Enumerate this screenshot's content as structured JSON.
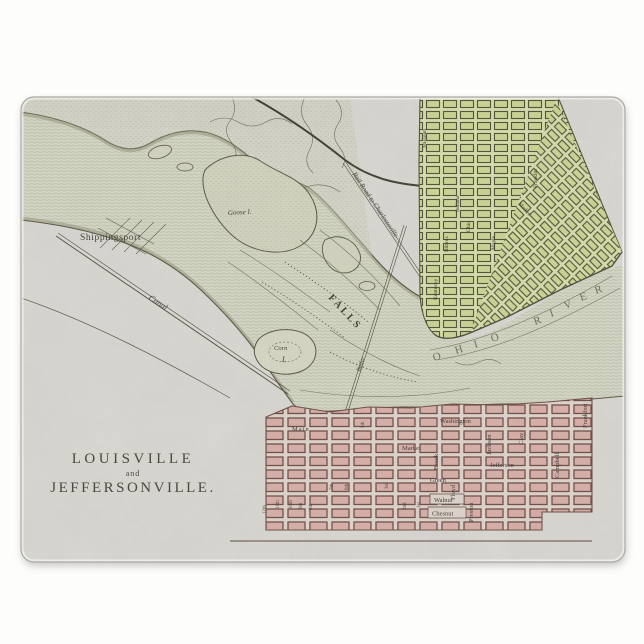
{
  "board": {
    "background_color": "#fdfdfc",
    "surface_color": "#d9d7d1",
    "edge_highlight": "#f1f0ed",
    "shadow_color": "#b9b7b1"
  },
  "map": {
    "title": {
      "line1": "LOUISVILLE",
      "line2": "and",
      "line3": "JEFFERSONVILLE."
    },
    "place_labels": {
      "shippingsport": "Shippingsport",
      "canal": "Canal",
      "goose_island": "Goose I.",
      "corn_island_line1": "Corn",
      "corn_island_line2": "I.",
      "falls": "FALLS",
      "butler": "Butler",
      "railroad": "Rail Road to Charlestoville",
      "shore_fragment": "nd"
    },
    "river": {
      "letters": [
        "O",
        "H",
        "I",
        "O",
        "R",
        "I",
        "V",
        "E",
        "R"
      ]
    },
    "louisville": {
      "grid_color": "#d6ada6",
      "streets_horizontal": [
        "Main",
        "Market",
        "Jefferson",
        "Green",
        "Walnut",
        "Chesnut",
        "Washington"
      ],
      "streets_vertical": [
        "Brook",
        "Floyd",
        "Preston",
        "Jackson",
        "Clay",
        "Campbell",
        "Frankfort"
      ],
      "streets_numbered": [
        "12th",
        "11th",
        "10th",
        "9th",
        "8th",
        "7th",
        "6th",
        "5th",
        "3rd",
        "2nd",
        "1st"
      ]
    },
    "jeffersonville": {
      "grid_color": "#c9d491",
      "streets": [
        "Missouri",
        "Indiana",
        "Ohio",
        "Illinois",
        "Kentucky",
        "Maple",
        "Market",
        "Franklin"
      ]
    },
    "ink_color": "#4c4a38",
    "water_line_color": "#a9ac94"
  }
}
